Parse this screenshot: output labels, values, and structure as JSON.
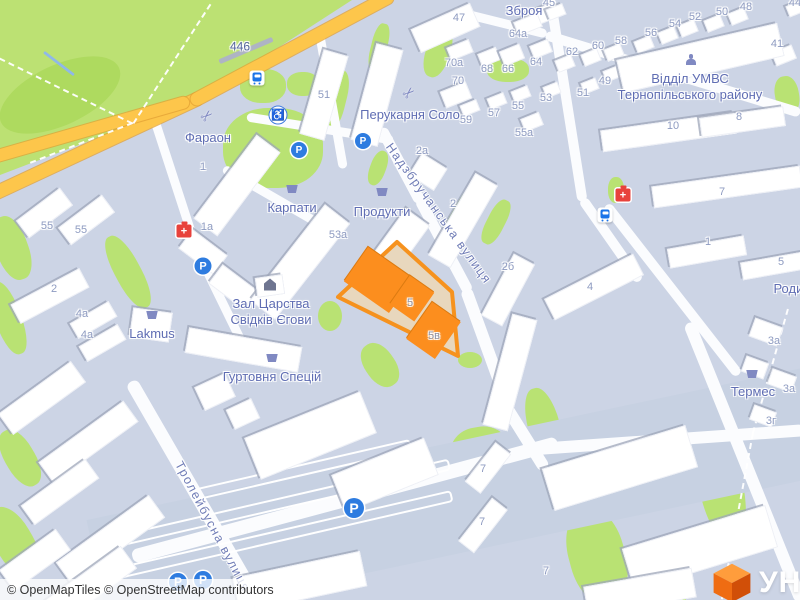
{
  "attribution": {
    "text": "© OpenMapTiles © OpenStreetMap contributors"
  },
  "logo": {
    "partial_text": "УН",
    "cube_top": "#ff9d3c",
    "cube_left": "#ef6c12",
    "cube_right": "#d14f08"
  },
  "colors": {
    "land": "#ccd4e5",
    "park": "#bce173",
    "road_yellow": "#fdc64b",
    "highlight_stroke": "#f6921e",
    "highlight_fill": "#e8d7bd",
    "highlight_building": "#fc8e1e",
    "poi_label": "#5f6db3",
    "house_number": "#8e9bc1"
  },
  "map": {
    "park_points": [
      [
        0,
        0
      ],
      [
        352,
        0
      ],
      [
        205,
        95
      ],
      [
        118,
        130
      ],
      [
        0,
        175
      ]
    ],
    "park_shade": [
      60,
      95,
      130,
      60,
      -25,
      50
    ],
    "greens": [
      [
        273,
        148,
        100,
        80,
        0,
        45
      ],
      [
        263,
        86,
        46,
        34,
        0,
        45
      ],
      [
        303,
        84,
        32,
        24,
        0,
        45
      ],
      [
        334,
        100,
        24,
        62,
        14,
        40
      ],
      [
        379,
        47,
        16,
        48,
        14,
        40
      ],
      [
        438,
        52,
        24,
        52,
        18,
        45
      ],
      [
        508,
        70,
        42,
        24,
        0,
        45
      ],
      [
        463,
        213,
        20,
        70,
        30,
        40
      ],
      [
        496,
        222,
        18,
        48,
        27,
        40
      ],
      [
        470,
        360,
        24,
        16,
        0,
        50
      ],
      [
        787,
        95,
        24,
        38,
        -10,
        45
      ],
      [
        128,
        272,
        26,
        80,
        -28,
        45
      ],
      [
        12,
        248,
        32,
        66,
        -20,
        45
      ],
      [
        8,
        318,
        26,
        76,
        -20,
        45
      ],
      [
        20,
        458,
        30,
        62,
        -30,
        45
      ],
      [
        14,
        542,
        38,
        76,
        -30,
        45
      ],
      [
        330,
        316,
        24,
        30,
        0,
        50
      ],
      [
        380,
        365,
        30,
        48,
        -35,
        45
      ],
      [
        545,
        430,
        32,
        86,
        -15,
        45
      ],
      [
        480,
        452,
        58,
        50,
        -10,
        45
      ],
      [
        597,
        556,
        56,
        96,
        -15,
        45
      ],
      [
        718,
        472,
        44,
        138,
        -12,
        40
      ],
      [
        664,
        598,
        44,
        50,
        0,
        45
      ],
      [
        378,
        168,
        16,
        36,
        20,
        45
      ],
      [
        616,
        190,
        16,
        26,
        0,
        45
      ]
    ],
    "pale_zones": [
      [
        455,
        498,
        730,
        110,
        -12
      ]
    ],
    "roads_white": [
      [
        401,
        165,
        84,
        11,
        62
      ],
      [
        444,
        245,
        106,
        11,
        62
      ],
      [
        486,
        345,
        120,
        12,
        70
      ],
      [
        522,
        432,
        88,
        12,
        58
      ],
      [
        320,
        128,
        148,
        9,
        9
      ],
      [
        331,
        98,
        142,
        9,
        80
      ],
      [
        272,
        196,
        112,
        9,
        30
      ],
      [
        174,
        179,
        152,
        9,
        72
      ],
      [
        220,
        297,
        108,
        9,
        64
      ],
      [
        500,
        22,
        96,
        9,
        14
      ],
      [
        673,
        74,
        266,
        10,
        17
      ],
      [
        566,
        100,
        205,
        10,
        81
      ],
      [
        611,
        240,
        100,
        10,
        55
      ],
      [
        672,
        290,
        215,
        10,
        52
      ],
      [
        745,
        462,
        300,
        12,
        68
      ],
      [
        195,
        492,
        256,
        13,
        60
      ],
      [
        345,
        500,
        440,
        14,
        -15
      ],
      [
        665,
        440,
        280,
        12,
        -4
      ]
    ],
    "roads_yellow": [
      [
        95,
        146,
        235,
        13,
        -25
      ],
      [
        292,
        48,
        228,
        13,
        -28
      ],
      [
        88,
        130,
        210,
        12,
        -16
      ]
    ],
    "railway": [
      246,
      50,
      58,
      5,
      -23
    ],
    "paths_dashed": [
      [
        0,
        57,
        133,
        122
      ],
      [
        133,
        122,
        210,
        3
      ],
      [
        133,
        122,
        30,
        162
      ],
      [
        788,
        308,
        753,
        432
      ],
      [
        753,
        432,
        722,
        598
      ]
    ],
    "stream": [
      44,
      50,
      74,
      73
    ],
    "parking_rows": [
      [
        285,
        500,
        330,
        -13
      ],
      [
        268,
        536,
        370,
        -13
      ],
      [
        300,
        468,
        220,
        -13
      ]
    ],
    "buildings": [
      [
        445,
        28,
        65,
        26,
        -24
      ],
      [
        540,
        16,
        34,
        16,
        -22
      ],
      [
        528,
        24,
        26,
        15,
        -22
      ],
      [
        460,
        50,
        24,
        14,
        -22
      ],
      [
        489,
        57,
        20,
        14,
        -22
      ],
      [
        512,
        55,
        22,
        16,
        -22
      ],
      [
        541,
        49,
        20,
        14,
        -22
      ],
      [
        456,
        95,
        28,
        18,
        -22
      ],
      [
        470,
        108,
        18,
        12,
        -22
      ],
      [
        497,
        101,
        18,
        12,
        -22
      ],
      [
        521,
        94,
        18,
        12,
        -22
      ],
      [
        532,
        122,
        20,
        14,
        -22
      ],
      [
        552,
        90,
        16,
        12,
        -22
      ],
      [
        590,
        86,
        16,
        12,
        -22
      ],
      [
        612,
        74,
        16,
        12,
        -22
      ],
      [
        556,
        12,
        18,
        12,
        -22
      ],
      [
        738,
        16,
        18,
        13,
        -22
      ],
      [
        714,
        23,
        18,
        13,
        -22
      ],
      [
        688,
        28,
        18,
        13,
        -22
      ],
      [
        668,
        35,
        18,
        13,
        -22
      ],
      [
        644,
        44,
        18,
        13,
        -22
      ],
      [
        614,
        52,
        18,
        13,
        -22
      ],
      [
        591,
        57,
        18,
        13,
        -22
      ],
      [
        565,
        63,
        18,
        13,
        -22
      ],
      [
        784,
        55,
        22,
        15,
        -22
      ],
      [
        795,
        9,
        16,
        12,
        -22
      ],
      [
        700,
        58,
        165,
        34,
        -13
      ],
      [
        668,
        132,
        135,
        22,
        -8
      ],
      [
        742,
        122,
        85,
        20,
        -8
      ],
      [
        727,
        187,
        150,
        22,
        -8
      ],
      [
        707,
        252,
        78,
        20,
        -10
      ],
      [
        778,
        265,
        75,
        18,
        -10
      ],
      [
        594,
        287,
        100,
        24,
        -27
      ],
      [
        766,
        332,
        30,
        20,
        20
      ],
      [
        782,
        380,
        26,
        17,
        20
      ],
      [
        763,
        416,
        24,
        16,
        20
      ],
      [
        755,
        367,
        24,
        17,
        20
      ],
      [
        428,
        172,
        30,
        26,
        32
      ],
      [
        463,
        220,
        26,
        95,
        30
      ],
      [
        508,
        290,
        24,
        70,
        28
      ],
      [
        510,
        372,
        26,
        115,
        15
      ],
      [
        324,
        95,
        26,
        88,
        16
      ],
      [
        377,
        95,
        28,
        100,
        15
      ],
      [
        237,
        185,
        30,
        105,
        37
      ],
      [
        203,
        252,
        44,
        24,
        37
      ],
      [
        233,
        287,
        44,
        24,
        37
      ],
      [
        300,
        262,
        32,
        122,
        38
      ],
      [
        390,
        255,
        30,
        95,
        36
      ],
      [
        270,
        286,
        28,
        20,
        -8
      ],
      [
        243,
        350,
        115,
        26,
        10
      ],
      [
        151,
        325,
        40,
        30,
        8
      ],
      [
        44,
        213,
        55,
        22,
        -37
      ],
      [
        86,
        220,
        55,
        22,
        -37
      ],
      [
        50,
        296,
        78,
        22,
        -28
      ],
      [
        93,
        320,
        45,
        18,
        -30
      ],
      [
        102,
        343,
        45,
        18,
        -30
      ],
      [
        42,
        398,
        90,
        26,
        -36
      ],
      [
        88,
        442,
        105,
        26,
        -36
      ],
      [
        60,
        492,
        80,
        24,
        -36
      ],
      [
        110,
        540,
        115,
        28,
        -36
      ],
      [
        35,
        560,
        70,
        26,
        -36
      ],
      [
        215,
        392,
        34,
        26,
        -25
      ],
      [
        243,
        414,
        28,
        22,
        -25
      ],
      [
        310,
        435,
        125,
        45,
        -22
      ],
      [
        385,
        475,
        100,
        40,
        -22
      ],
      [
        300,
        582,
        130,
        36,
        -12
      ],
      [
        90,
        585,
        95,
        28,
        -36
      ],
      [
        488,
        468,
        20,
        50,
        38
      ],
      [
        483,
        525,
        20,
        55,
        38
      ],
      [
        620,
        468,
        150,
        44,
        -17
      ],
      [
        700,
        548,
        150,
        44,
        -17
      ],
      [
        640,
        592,
        110,
        30,
        -10
      ]
    ],
    "highlight_lot": {
      "points": "397,242 452,292 458,356 338,297",
      "buildings": [
        [
          378,
          280,
          55,
          42,
          35
        ],
        [
          412,
          298,
          30,
          35,
          35
        ],
        [
          433,
          330,
          35,
          45,
          35
        ]
      ],
      "labels": [
        {
          "t": "5",
          "x": 410,
          "y": 304
        },
        {
          "t": "5в",
          "x": 434,
          "y": 337
        }
      ]
    },
    "road_ref": {
      "t": "446",
      "x": 240,
      "y": 47
    },
    "street_labels": [
      {
        "t": "Надзбручанська вулиця",
        "x": 438,
        "y": 214,
        "rot": 54
      },
      {
        "t": "Тролейбусна вулиця",
        "x": 212,
        "y": 527,
        "rot": 62
      }
    ],
    "poi_labels": [
      {
        "t": "Зброя",
        "x": 524,
        "y": 11,
        "icon": null,
        "ix": 0,
        "iy": 0
      },
      {
        "t": "Перукарня Соло",
        "x": 410,
        "y": 115,
        "icon": "scissors",
        "ix": 409,
        "iy": 93
      },
      {
        "t": "Фараон",
        "x": 208,
        "y": 138,
        "icon": "scissors",
        "ix": 207,
        "iy": 116
      },
      {
        "t": "Карпати",
        "x": 292,
        "y": 208,
        "icon": "basket",
        "ix": 292,
        "iy": 189
      },
      {
        "t": "Продукти",
        "x": 382,
        "y": 212,
        "icon": "basket",
        "ix": 382,
        "iy": 192
      },
      {
        "t": "Lakmus",
        "x": 152,
        "y": 334,
        "icon": "basket",
        "ix": 152,
        "iy": 315
      },
      {
        "t": "Зал Царства\nСвідків Єгови",
        "x": 271,
        "y": 312,
        "icon": "hall",
        "ix": 270,
        "iy": 287
      },
      {
        "t": "Гуртовня Спецій",
        "x": 272,
        "y": 377,
        "icon": "basket",
        "ix": 272,
        "iy": 358
      },
      {
        "t": "Відділ УМВС\nТернопільського району",
        "x": 690,
        "y": 87,
        "icon": "person",
        "ix": 691,
        "iy": 62
      },
      {
        "t": "Термес",
        "x": 753,
        "y": 392,
        "icon": "basket",
        "ix": 752,
        "iy": 374
      },
      {
        "t": "Родин",
        "x": 792,
        "y": 289,
        "icon": null,
        "ix": 0,
        "iy": 0
      }
    ],
    "house_numbers": [
      [
        459,
        19,
        "47"
      ],
      [
        518,
        35,
        "64а"
      ],
      [
        454,
        64,
        "70а"
      ],
      [
        487,
        70,
        "68"
      ],
      [
        508,
        70,
        "66"
      ],
      [
        536,
        63,
        "64"
      ],
      [
        458,
        82,
        "70"
      ],
      [
        466,
        121,
        "59"
      ],
      [
        494,
        114,
        "57"
      ],
      [
        518,
        107,
        "55"
      ],
      [
        524,
        134,
        "55а"
      ],
      [
        324,
        96,
        "51"
      ],
      [
        422,
        152,
        "2а"
      ],
      [
        549,
        4,
        "45"
      ],
      [
        746,
        8,
        "48"
      ],
      [
        722,
        13,
        "50"
      ],
      [
        695,
        18,
        "52"
      ],
      [
        675,
        25,
        "54"
      ],
      [
        651,
        34,
        "56"
      ],
      [
        621,
        42,
        "58"
      ],
      [
        598,
        47,
        "60"
      ],
      [
        572,
        53,
        "62"
      ],
      [
        777,
        45,
        "41"
      ],
      [
        605,
        82,
        "49"
      ],
      [
        583,
        94,
        "51"
      ],
      [
        546,
        99,
        "53"
      ],
      [
        673,
        127,
        "10"
      ],
      [
        739,
        118,
        "8"
      ],
      [
        722,
        193,
        "7"
      ],
      [
        203,
        168,
        "1"
      ],
      [
        207,
        228,
        "1а"
      ],
      [
        47,
        227,
        "55"
      ],
      [
        81,
        231,
        "55"
      ],
      [
        54,
        290,
        "2"
      ],
      [
        82,
        315,
        "4а"
      ],
      [
        87,
        336,
        "4а"
      ],
      [
        338,
        236,
        "53а"
      ],
      [
        453,
        205,
        "2"
      ],
      [
        508,
        268,
        "2б"
      ],
      [
        708,
        243,
        "1"
      ],
      [
        781,
        263,
        "5"
      ],
      [
        590,
        288,
        "4"
      ],
      [
        774,
        342,
        "3а"
      ],
      [
        789,
        390,
        "3а"
      ],
      [
        771,
        422,
        "3г"
      ],
      [
        483,
        470,
        "7"
      ],
      [
        482,
        523,
        "7"
      ],
      [
        546,
        572,
        "7"
      ],
      [
        795,
        4,
        "44"
      ]
    ],
    "markers": {
      "parking": [
        [
          363,
          141,
          16
        ],
        [
          299,
          150,
          16
        ],
        [
          203,
          266,
          17
        ],
        [
          354,
          508,
          20
        ],
        [
          178,
          582,
          18
        ],
        [
          203,
          580,
          18
        ]
      ],
      "bus": [
        [
          257,
          78
        ],
        [
          605,
          215
        ]
      ],
      "pharmacy": [
        [
          184,
          231
        ],
        [
          623,
          195
        ]
      ],
      "wheelchair": [
        [
          278,
          115
        ]
      ]
    }
  }
}
